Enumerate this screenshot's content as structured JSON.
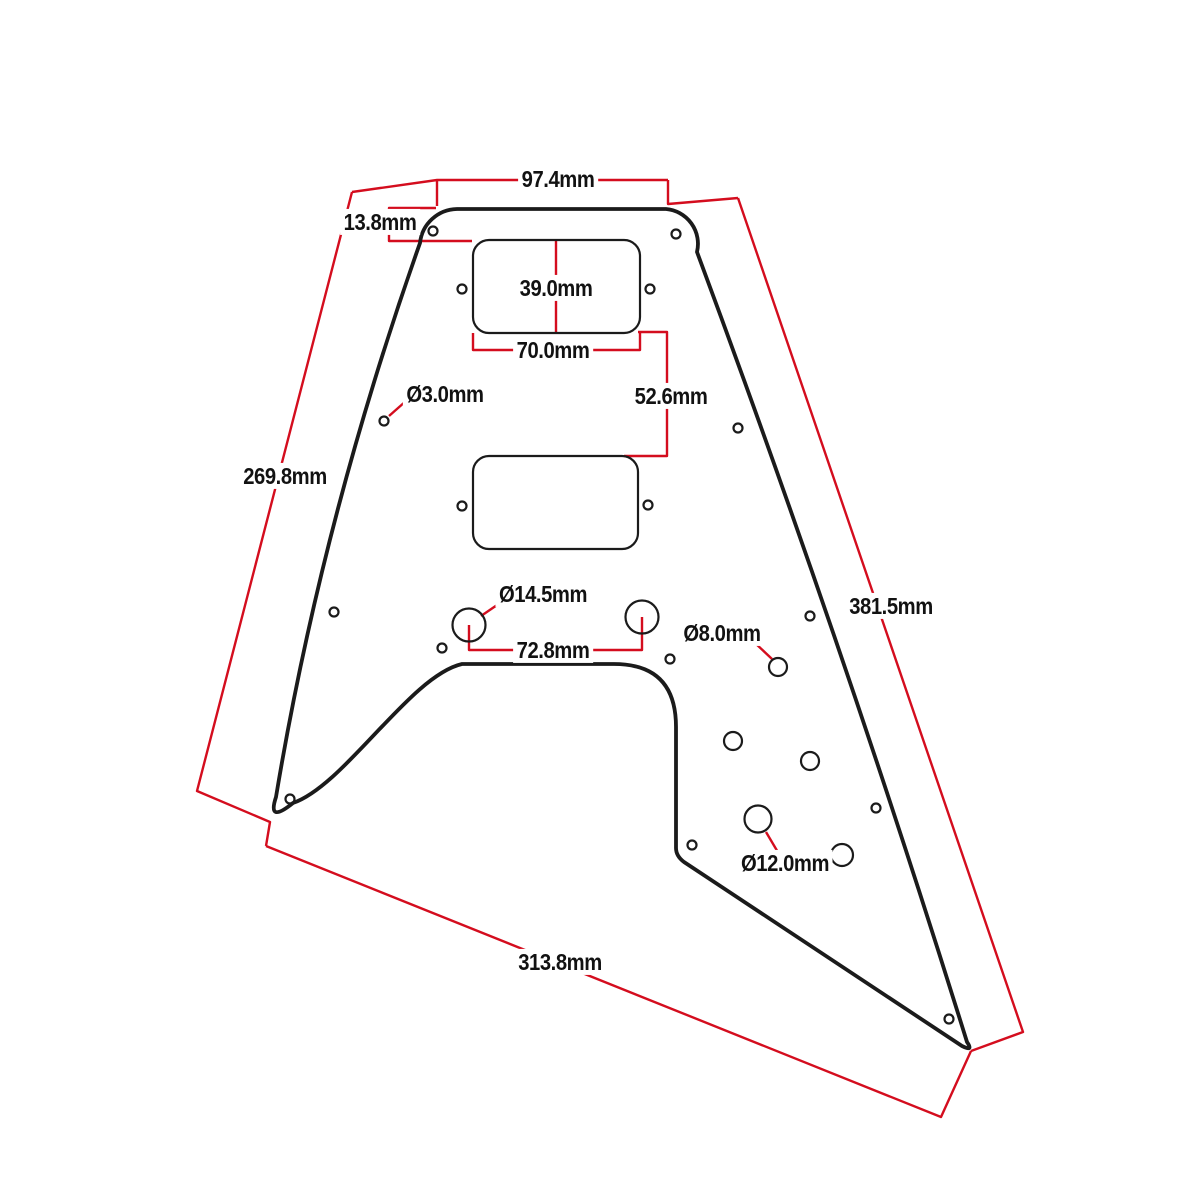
{
  "drawing": {
    "type": "technical-dimension-drawing",
    "subject": "flying-v-style-pickguard",
    "units": "mm",
    "colors": {
      "background": "#ffffff",
      "outline": "#1b1b1b",
      "dimension_lines": "#d40d1e",
      "label_text": "#121212"
    },
    "labels": {
      "top_width": "97.4mm",
      "top_offset": "13.8mm",
      "pickup_height": "39.0mm",
      "pickup_width": "70.0mm",
      "screw_hole": "Ø3.0mm",
      "pickup_gap": "52.6mm",
      "left_edge": "269.8mm",
      "pot_hole": "Ø14.5mm",
      "right_edge": "381.5mm",
      "jack_hole": "Ø8.0mm",
      "pot_spacing": "72.8mm",
      "toggle_hole": "Ø12.0mm",
      "bottom_edge": "313.8mm"
    }
  }
}
